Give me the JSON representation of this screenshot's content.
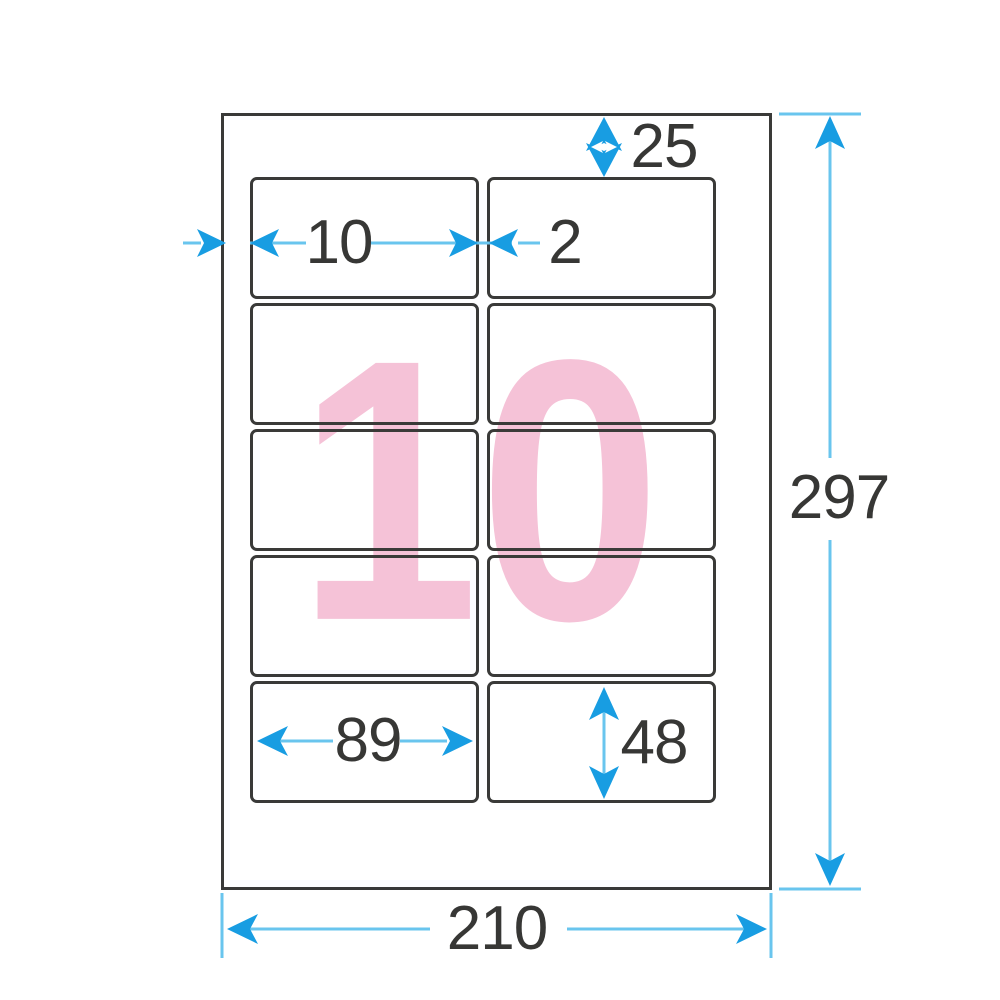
{
  "diagram": {
    "watermark_count": "10",
    "grid": {
      "rows": 5,
      "columns": 2,
      "label_count": 10
    },
    "dimensions": {
      "sheet_width": "210",
      "sheet_height": "297",
      "top_margin": "25",
      "left_margin": "10",
      "column_gap": "2",
      "label_width": "89",
      "label_height": "48"
    },
    "colors": {
      "dimension_arrow": "#189de2",
      "dimension_line": "#69c5ee",
      "watermark_pink": "#f5c2d7",
      "outline_dark": "#3a3a38",
      "text_dark": "#373735"
    }
  }
}
